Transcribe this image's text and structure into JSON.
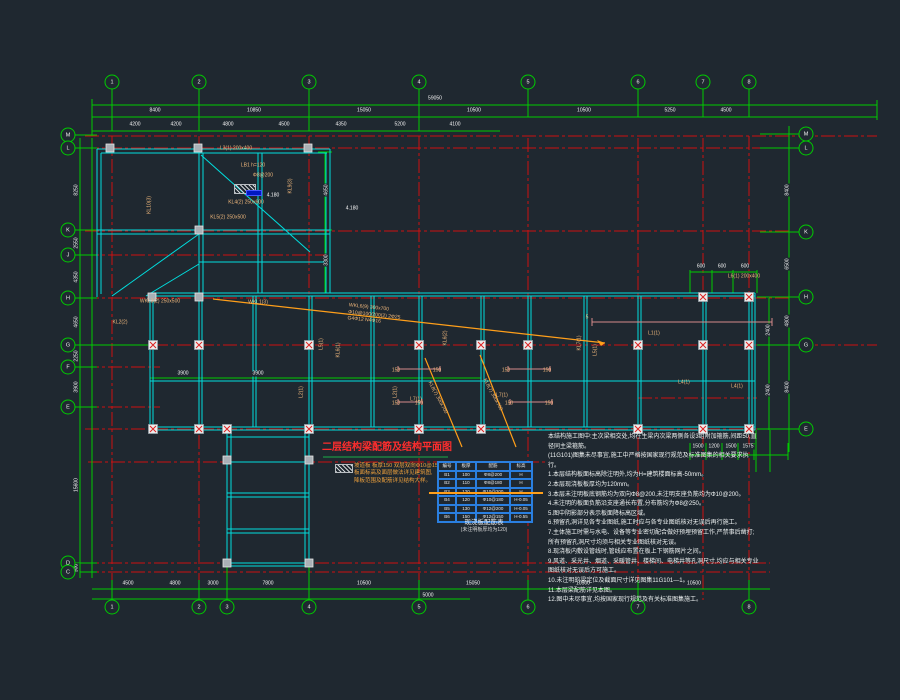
{
  "title": "二层结构梁配筋及结构平面图",
  "accent_colors": {
    "background": "#1f2830",
    "grid_red": "#cc1111",
    "dimension_green": "#00cc00",
    "beam_cyan": "#00dede",
    "label_tan": "#f0b87c",
    "leader_orange": "#ff9f1a",
    "table_blue": "#2a7fe0",
    "title_red": "#ff2d2d"
  },
  "bubbles": [
    {
      "x": 112,
      "y": 82,
      "t": "1"
    },
    {
      "x": 199,
      "y": 82,
      "t": "2"
    },
    {
      "x": 309,
      "y": 82,
      "t": "3"
    },
    {
      "x": 419,
      "y": 82,
      "t": "4"
    },
    {
      "x": 528,
      "y": 82,
      "t": "5"
    },
    {
      "x": 638,
      "y": 82,
      "t": "6"
    },
    {
      "x": 703,
      "y": 82,
      "t": "7"
    },
    {
      "x": 749,
      "y": 82,
      "t": "8"
    },
    {
      "x": 112,
      "y": 607,
      "t": "1"
    },
    {
      "x": 199,
      "y": 607,
      "t": "2"
    },
    {
      "x": 227,
      "y": 607,
      "t": "3"
    },
    {
      "x": 309,
      "y": 607,
      "t": "4"
    },
    {
      "x": 419,
      "y": 607,
      "t": "5"
    },
    {
      "x": 528,
      "y": 607,
      "t": "6"
    },
    {
      "x": 638,
      "y": 607,
      "t": "7"
    },
    {
      "x": 749,
      "y": 607,
      "t": "8"
    },
    {
      "x": 68,
      "y": 135,
      "t": "M"
    },
    {
      "x": 68,
      "y": 148,
      "t": "L"
    },
    {
      "x": 68,
      "y": 230,
      "t": "K"
    },
    {
      "x": 68,
      "y": 255,
      "t": "J"
    },
    {
      "x": 68,
      "y": 298,
      "t": "H"
    },
    {
      "x": 68,
      "y": 345,
      "t": "G"
    },
    {
      "x": 68,
      "y": 367,
      "t": "F"
    },
    {
      "x": 68,
      "y": 407,
      "t": "E"
    },
    {
      "x": 68,
      "y": 563,
      "t": "D"
    },
    {
      "x": 68,
      "y": 572,
      "t": "C"
    },
    {
      "x": 806,
      "y": 134,
      "t": "M"
    },
    {
      "x": 806,
      "y": 148,
      "t": "L"
    },
    {
      "x": 806,
      "y": 232,
      "t": "K"
    },
    {
      "x": 806,
      "y": 297,
      "t": "H"
    },
    {
      "x": 806,
      "y": 345,
      "t": "G"
    },
    {
      "x": 806,
      "y": 429,
      "t": "E"
    }
  ],
  "dims": [
    {
      "x": 435,
      "y": 99,
      "t": "59050"
    },
    {
      "x": 155,
      "y": 111,
      "t": "8400"
    },
    {
      "x": 254,
      "y": 111,
      "t": "10850"
    },
    {
      "x": 364,
      "y": 111,
      "t": "15050"
    },
    {
      "x": 474,
      "y": 111,
      "t": "10500"
    },
    {
      "x": 584,
      "y": 111,
      "t": "10500"
    },
    {
      "x": 670,
      "y": 111,
      "t": "5250"
    },
    {
      "x": 726,
      "y": 111,
      "t": "4500"
    },
    {
      "x": 135,
      "y": 125,
      "t": "4200"
    },
    {
      "x": 176,
      "y": 125,
      "t": "4200"
    },
    {
      "x": 228,
      "y": 125,
      "t": "4800"
    },
    {
      "x": 284,
      "y": 125,
      "t": "4500"
    },
    {
      "x": 341,
      "y": 125,
      "t": "4350"
    },
    {
      "x": 400,
      "y": 125,
      "t": "5200"
    },
    {
      "x": 455,
      "y": 125,
      "t": "4100"
    },
    {
      "x": 128,
      "y": 584,
      "t": "4500"
    },
    {
      "x": 175,
      "y": 584,
      "t": "4800"
    },
    {
      "x": 213,
      "y": 584,
      "t": "3000"
    },
    {
      "x": 268,
      "y": 584,
      "t": "7800"
    },
    {
      "x": 364,
      "y": 584,
      "t": "10500"
    },
    {
      "x": 473,
      "y": 584,
      "t": "15050"
    },
    {
      "x": 583,
      "y": 584,
      "t": "10500"
    },
    {
      "x": 694,
      "y": 584,
      "t": "10500"
    },
    {
      "x": 428,
      "y": 596,
      "t": "5000"
    },
    {
      "x": 77,
      "y": 190,
      "t": "8250",
      "rot": -90
    },
    {
      "x": 77,
      "y": 243,
      "t": "2550",
      "rot": -90
    },
    {
      "x": 77,
      "y": 277,
      "t": "4350",
      "rot": -90
    },
    {
      "x": 77,
      "y": 322,
      "t": "4650",
      "rot": -90
    },
    {
      "x": 77,
      "y": 356,
      "t": "2250",
      "rot": -90
    },
    {
      "x": 77,
      "y": 387,
      "t": "3900",
      "rot": -90
    },
    {
      "x": 77,
      "y": 485,
      "t": "15600",
      "rot": -90
    },
    {
      "x": 77,
      "y": 568,
      "t": "900",
      "rot": -90
    },
    {
      "x": 788,
      "y": 190,
      "t": "8400",
      "rot": -90
    },
    {
      "x": 788,
      "y": 264,
      "t": "6500",
      "rot": -90
    },
    {
      "x": 788,
      "y": 321,
      "t": "4800",
      "rot": -90
    },
    {
      "x": 788,
      "y": 387,
      "t": "8400",
      "rot": -90
    },
    {
      "x": 769,
      "y": 330,
      "t": "2400",
      "rot": -90
    },
    {
      "x": 769,
      "y": 390,
      "t": "2400",
      "rot": -90
    },
    {
      "x": 701,
      "y": 267,
      "t": "600"
    },
    {
      "x": 722,
      "y": 267,
      "t": "600"
    },
    {
      "x": 745,
      "y": 267,
      "t": "600"
    },
    {
      "x": 698,
      "y": 447,
      "t": "1500"
    },
    {
      "x": 714,
      "y": 447,
      "t": "1200"
    },
    {
      "x": 731,
      "y": 447,
      "t": "1500"
    },
    {
      "x": 748,
      "y": 447,
      "t": "1575"
    },
    {
      "x": 183,
      "y": 374,
      "t": "3900"
    },
    {
      "x": 258,
      "y": 374,
      "t": "3900"
    },
    {
      "x": 327,
      "y": 190,
      "t": "4650",
      "rot": -90
    },
    {
      "x": 327,
      "y": 260,
      "t": "3300",
      "rot": -90
    }
  ],
  "beam_labels": [
    {
      "x": 236,
      "y": 149,
      "t": "L3(1) 200x400"
    },
    {
      "x": 253,
      "y": 166,
      "t": "LB1 h=120"
    },
    {
      "x": 263,
      "y": 176,
      "t": "Φ8@200"
    },
    {
      "x": 246,
      "y": 203,
      "t": "KL4(2) 250x600"
    },
    {
      "x": 291,
      "y": 186,
      "t": "KL9(3)",
      "rot": -90
    },
    {
      "x": 228,
      "y": 218,
      "t": "KL5(2) 250x500"
    },
    {
      "x": 150,
      "y": 205,
      "t": "KL10(3)",
      "rot": -90
    },
    {
      "x": 120,
      "y": 323,
      "t": "KL2(2)"
    },
    {
      "x": 160,
      "y": 302,
      "t": "WKL3(2) 250x500"
    },
    {
      "x": 258,
      "y": 303,
      "t": "WKL1(3)"
    },
    {
      "x": 322,
      "y": 344,
      "t": "L5(1)",
      "rot": -90
    },
    {
      "x": 339,
      "y": 350,
      "t": "KL6(1)",
      "rot": -90
    },
    {
      "x": 446,
      "y": 338,
      "t": "KL6(2)",
      "rot": -90
    },
    {
      "x": 580,
      "y": 343,
      "t": "KL7(1)",
      "rot": -90
    },
    {
      "x": 596,
      "y": 350,
      "t": "L5(1)",
      "rot": -90
    },
    {
      "x": 396,
      "y": 392,
      "t": "L2(1)",
      "rot": -90
    },
    {
      "x": 302,
      "y": 392,
      "t": "L2(1)",
      "rot": -90
    },
    {
      "x": 416,
      "y": 400,
      "t": "L7(1)"
    },
    {
      "x": 502,
      "y": 396,
      "t": "L7(1)"
    },
    {
      "x": 654,
      "y": 334,
      "t": "L1(1)"
    },
    {
      "x": 684,
      "y": 383,
      "t": "L4(1)"
    },
    {
      "x": 737,
      "y": 387,
      "t": "L4(1)"
    },
    {
      "x": 744,
      "y": 277,
      "t": "L6(1) 200x400"
    },
    {
      "x": 437,
      "y": 398,
      "t": "KL8(7) 300x700",
      "rot": 62
    },
    {
      "x": 492,
      "y": 395,
      "t": "KL8(7) 300x700",
      "rot": 62
    },
    {
      "x": 396,
      "y": 371,
      "t": "150"
    },
    {
      "x": 437,
      "y": 371,
      "t": "150"
    },
    {
      "x": 506,
      "y": 371,
      "t": "150"
    },
    {
      "x": 547,
      "y": 371,
      "t": "150"
    },
    {
      "x": 396,
      "y": 404,
      "t": "150"
    },
    {
      "x": 419,
      "y": 404,
      "t": "150"
    },
    {
      "x": 509,
      "y": 404,
      "t": "150"
    },
    {
      "x": 549,
      "y": 404,
      "t": "150"
    },
    {
      "x": 587,
      "y": 318,
      "t": "5"
    }
  ],
  "white_labels": [
    {
      "x": 273,
      "y": 196,
      "t": "4.180"
    },
    {
      "x": 352,
      "y": 209,
      "t": "4.180"
    }
  ],
  "leader_note": [
    "WKL6(9) 300x700",
    "Φ10@100/200(2) 2Φ25",
    "G4Φ12  N4Φ16"
  ],
  "legend": {
    "lines": [
      "坡道板 板厚150 双层双向Φ10@150,",
      "板面标高及面层做法详见建筑图,",
      "降板范围及配筋详见结构大样。"
    ]
  },
  "notes": [
    "本结构施工图中:主次梁相交处,均在主梁内次梁两侧各设3组附加箍筋,间距50,直径同主梁箍筋。",
    "(11G101)图集未尽事宜,施工中严格按国家现行规范及标准图集的相关要求执行。",
    "1.本层结构板面标高除注明外,均为H=建筑楼面标高-50mm。",
    "2.本层现浇板板厚均为120mm。",
    "3.本层未注明板底钢筋均为双向Φ8@200,未注明支座负筋均为Φ10@200。",
    "4.未注明的板面负筋沿支座通长布置,分布筋均为Φ8@250。",
    "5.图中阴影部分表示板面降标高区域。",
    "6.预留孔洞详见各专业图纸,施工时应与各专业图纸核对无误后再行施工。",
    "7.主体施工时需与水电、设备等专业密切配合做好预埋预留工作,严禁事后凿打;所有预留孔洞尺寸均须与相关专业图纸核对无误。",
    "8.现浇板内敷设管线时,管线应布置在板上下钢筋网片之间。",
    "9.风道、采光井、烟道、采暖管井、楼梯间、电梯井等孔洞尺寸,均应与相关专业图纸核对无误后方可施工。",
    "10.未注明的梁定位及截面尺寸详见图集11G101—1。",
    "11.本层梁配筋详见本图。",
    "12.图中未尽事宜,均按国家现行规范及有关标准图集施工。"
  ],
  "table": {
    "title": "现浇板配筋表",
    "subtitle": "(未注明板厚均为120)",
    "cells": [
      "编号",
      "板厚",
      "配筋",
      "标高",
      "B1",
      "100",
      "Φ8@200",
      "H",
      "B2",
      "110",
      "Φ8@180",
      "H",
      "B3",
      "120",
      "Φ10@200",
      "H",
      "B4",
      "120",
      "Φ10@180",
      "H-0.05",
      "B5",
      "130",
      "Φ12@200",
      "H-0.05",
      "B6",
      "150",
      "Φ12@150",
      "H-0.55"
    ]
  },
  "columns": {
    "plain": [
      [
        110,
        148
      ],
      [
        198,
        148
      ],
      [
        308,
        148
      ],
      [
        199,
        230
      ],
      [
        152,
        297
      ],
      [
        199,
        297
      ],
      [
        227,
        460
      ],
      [
        309,
        460
      ],
      [
        227,
        563
      ],
      [
        309,
        563
      ]
    ],
    "braced": [
      [
        153,
        345
      ],
      [
        199,
        345
      ],
      [
        309,
        345
      ],
      [
        419,
        345
      ],
      [
        481,
        345
      ],
      [
        528,
        345
      ],
      [
        638,
        345
      ],
      [
        703,
        345
      ],
      [
        749,
        345
      ],
      [
        703,
        297
      ],
      [
        749,
        297
      ],
      [
        153,
        429
      ],
      [
        199,
        429
      ],
      [
        227,
        429
      ],
      [
        309,
        429
      ],
      [
        419,
        429
      ],
      [
        481,
        429
      ],
      [
        638,
        429
      ],
      [
        703,
        429
      ],
      [
        749,
        429
      ]
    ]
  }
}
